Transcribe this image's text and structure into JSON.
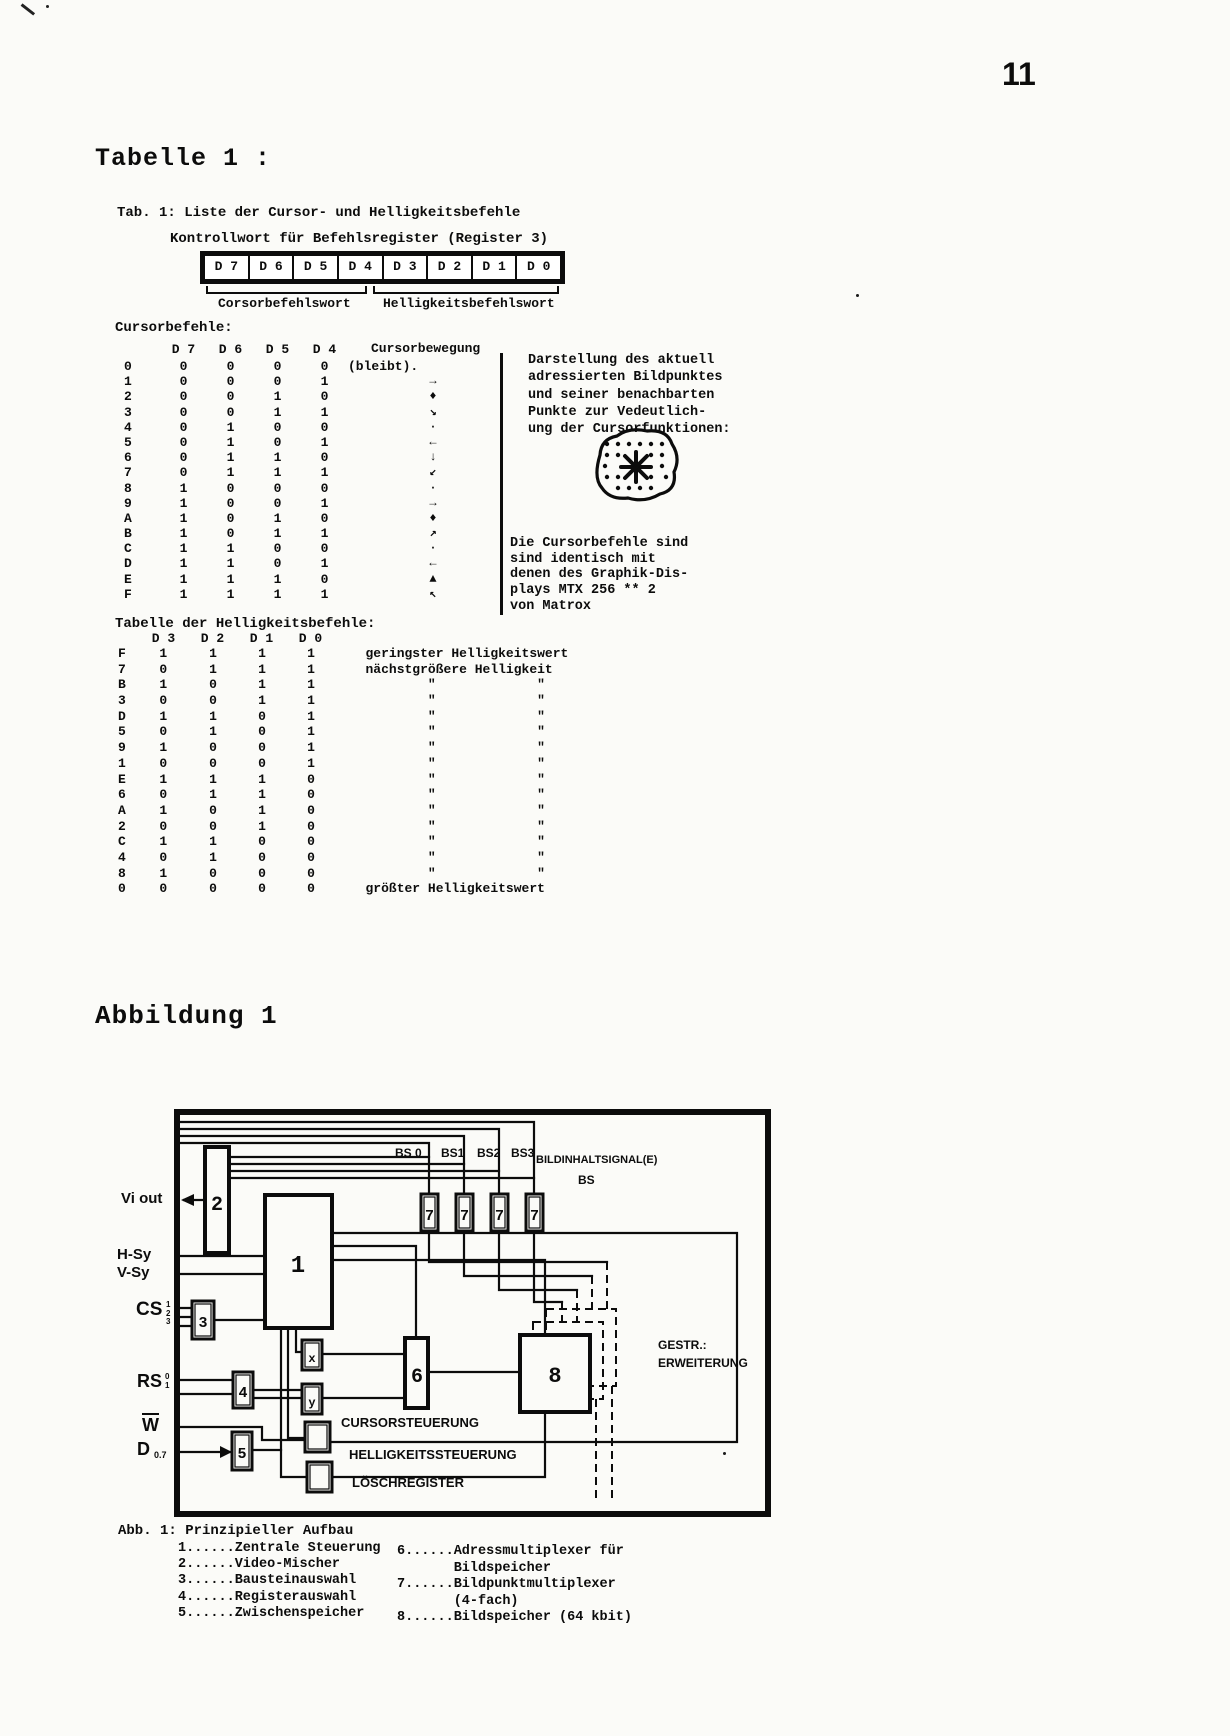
{
  "page": {
    "number": "11"
  },
  "table1": {
    "heading": "Tabelle 1 :",
    "caption1": "Tab. 1: Liste der Cursor- und Helligkeitsbefehle",
    "caption2": "Kontrollwort für Befehlsregister (Register 3)",
    "register_bits": [
      "D 7",
      "D 6",
      "D 5",
      "D 4",
      "D 3",
      "D 2",
      "D 1",
      "D 0"
    ],
    "bracket_left": "Corsorbefehlswort",
    "bracket_right": "Helligkeitsbefehlswort",
    "cursor": {
      "title": "Cursorbefehle:",
      "headers": [
        "D 7",
        "D 6",
        "D 5",
        "D 4"
      ],
      "movement_header": "Cursorbewegung",
      "movement_note": "(bleibt).",
      "rows": [
        {
          "hex": "0",
          "bits": [
            "0",
            "0",
            "0",
            "0"
          ],
          "arrow": ""
        },
        {
          "hex": "1",
          "bits": [
            "0",
            "0",
            "0",
            "1"
          ],
          "arrow": "→"
        },
        {
          "hex": "2",
          "bits": [
            "0",
            "0",
            "1",
            "0"
          ],
          "arrow": "♦"
        },
        {
          "hex": "3",
          "bits": [
            "0",
            "0",
            "1",
            "1"
          ],
          "arrow": "↘"
        },
        {
          "hex": "4",
          "bits": [
            "0",
            "1",
            "0",
            "0"
          ],
          "arrow": "·"
        },
        {
          "hex": "5",
          "bits": [
            "0",
            "1",
            "0",
            "1"
          ],
          "arrow": "←"
        },
        {
          "hex": "6",
          "bits": [
            "0",
            "1",
            "1",
            "0"
          ],
          "arrow": "↓"
        },
        {
          "hex": "7",
          "bits": [
            "0",
            "1",
            "1",
            "1"
          ],
          "arrow": "↙"
        },
        {
          "hex": "8",
          "bits": [
            "1",
            "0",
            "0",
            "0"
          ],
          "arrow": "·"
        },
        {
          "hex": "9",
          "bits": [
            "1",
            "0",
            "0",
            "1"
          ],
          "arrow": "→"
        },
        {
          "hex": "A",
          "bits": [
            "1",
            "0",
            "1",
            "0"
          ],
          "arrow": "♦"
        },
        {
          "hex": "B",
          "bits": [
            "1",
            "0",
            "1",
            "1"
          ],
          "arrow": "↗"
        },
        {
          "hex": "C",
          "bits": [
            "1",
            "1",
            "0",
            "0"
          ],
          "arrow": "·"
        },
        {
          "hex": "D",
          "bits": [
            "1",
            "1",
            "0",
            "1"
          ],
          "arrow": "←"
        },
        {
          "hex": "E",
          "bits": [
            "1",
            "1",
            "1",
            "0"
          ],
          "arrow": "▲"
        },
        {
          "hex": "F",
          "bits": [
            "1",
            "1",
            "1",
            "1"
          ],
          "arrow": "↖"
        }
      ],
      "note1": [
        "Darstellung des aktuell",
        "adressierten Bildpunktes",
        "und seiner benachbarten",
        "Punkte zur Vedeutlich-",
        "ung der Cursorfunktionen:"
      ],
      "note2": [
        "Die Cursorbefehle sind",
        "sind identisch mit",
        "denen des Graphik-Dis-",
        "plays MTX 256 ** 2",
        "von Matrox"
      ]
    },
    "brightness": {
      "title": "Tabelle der Helligkeitsbefehle:",
      "headers": [
        "D 3",
        "D 2",
        "D 1",
        "D 0"
      ],
      "rows": [
        {
          "hex": "F",
          "bits": [
            "1",
            "1",
            "1",
            "1"
          ],
          "note": "geringster Helligkeitswert"
        },
        {
          "hex": "7",
          "bits": [
            "0",
            "1",
            "1",
            "1"
          ],
          "note": "nächstgrößere Helligkeit"
        },
        {
          "hex": "B",
          "bits": [
            "1",
            "0",
            "1",
            "1"
          ],
          "note": "        \"             \""
        },
        {
          "hex": "3",
          "bits": [
            "0",
            "0",
            "1",
            "1"
          ],
          "note": "        \"             \""
        },
        {
          "hex": "D",
          "bits": [
            "1",
            "1",
            "0",
            "1"
          ],
          "note": "        \"             \""
        },
        {
          "hex": "5",
          "bits": [
            "0",
            "1",
            "0",
            "1"
          ],
          "note": "        \"             \""
        },
        {
          "hex": "9",
          "bits": [
            "1",
            "0",
            "0",
            "1"
          ],
          "note": "        \"             \""
        },
        {
          "hex": "1",
          "bits": [
            "0",
            "0",
            "0",
            "1"
          ],
          "note": "        \"             \""
        },
        {
          "hex": "E",
          "bits": [
            "1",
            "1",
            "1",
            "0"
          ],
          "note": "        \"             \""
        },
        {
          "hex": "6",
          "bits": [
            "0",
            "1",
            "1",
            "0"
          ],
          "note": "        \"             \""
        },
        {
          "hex": "A",
          "bits": [
            "1",
            "0",
            "1",
            "0"
          ],
          "note": "        \"             \""
        },
        {
          "hex": "2",
          "bits": [
            "0",
            "0",
            "1",
            "0"
          ],
          "note": "        \"             \""
        },
        {
          "hex": "C",
          "bits": [
            "1",
            "1",
            "0",
            "0"
          ],
          "note": "        \"             \""
        },
        {
          "hex": "4",
          "bits": [
            "0",
            "1",
            "0",
            "0"
          ],
          "note": "        \"             \""
        },
        {
          "hex": "8",
          "bits": [
            "1",
            "0",
            "0",
            "0"
          ],
          "note": "        \"             \""
        },
        {
          "hex": "0",
          "bits": [
            "0",
            "0",
            "0",
            "0"
          ],
          "note": "größter Helligkeitswert"
        }
      ]
    }
  },
  "figure": {
    "heading": "Abbildung 1",
    "signals": {
      "vi_out": "Vi out",
      "h_sy": "H-Sy",
      "v_sy": "V-Sy",
      "cs": "CS",
      "cs_subs": [
        "1",
        "2",
        "3"
      ],
      "rs": "RS",
      "rs_subs": [
        "0",
        "1"
      ],
      "w": "W",
      "d": "D",
      "d_sub": "0.7"
    },
    "bs_labels": [
      "BS 0",
      "BS1",
      "BS2",
      "BS3"
    ],
    "bildinhalt_1": "BILDINHALTSIGNAL(E)",
    "bildinhalt_2": "BS",
    "gestr_1": "GESTR.:",
    "gestr_2": "ERWEITERUNG",
    "label_cursorsteuerung": "CURSORSTEUERUNG",
    "label_helligkeitssteuerung": "HELLIGKEITSSTEUERUNG",
    "label_loeschregister": "LÖSCHREGISTER",
    "boxes": {
      "b1": "1",
      "b2": "2",
      "b3": "3",
      "b4": "4",
      "b5": "5",
      "b6": "6",
      "b7": "7",
      "b8": "8",
      "bx": "x",
      "by": "y"
    },
    "caption": "Abb. 1: Prinzipieller Aufbau",
    "legend_left": [
      "1......Zentrale Steuerung",
      "2......Video-Mischer",
      "3......Bausteinauswahl",
      "4......Registerauswahl",
      "5......Zwischenspeicher"
    ],
    "legend_right": [
      "6......Adressmultiplexer für",
      "       Bildspeicher",
      "7......Bildpunktmultiplexer",
      "       (4-fach)",
      "8......Bildspeicher (64 kbit)"
    ]
  }
}
